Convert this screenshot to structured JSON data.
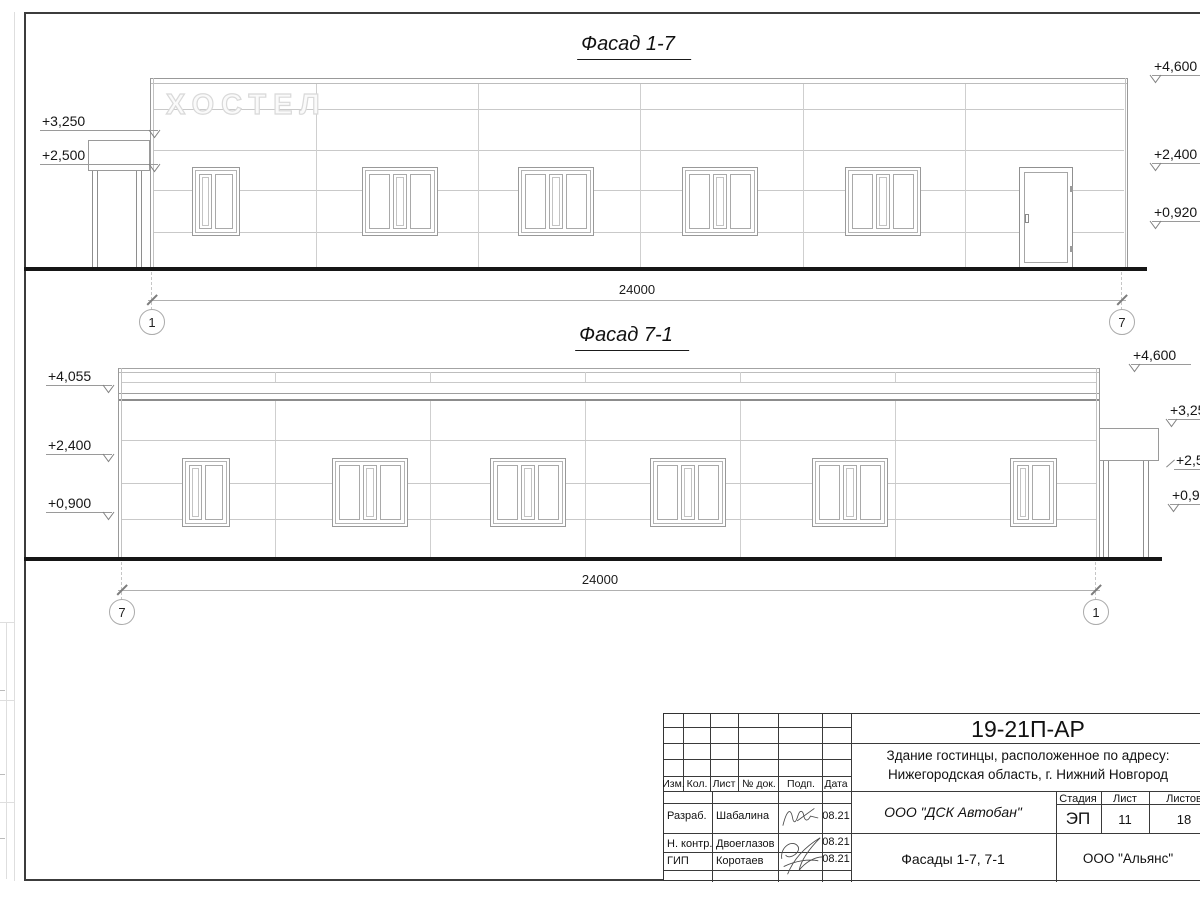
{
  "sheet": {
    "titles": {
      "facade1": "Фасад 1-7",
      "facade2": "Фасад 7-1"
    },
    "sign": "ХОСТЕЛ"
  },
  "facade1": {
    "marks_left": [
      "+3,250",
      "+2,500"
    ],
    "marks_right": [
      "+4,600",
      "+2,400",
      "+0,920"
    ],
    "dimension": "24000",
    "axis_left": "1",
    "axis_right": "7"
  },
  "facade2": {
    "marks_left": [
      "+4,055",
      "+2,400",
      "+0,900"
    ],
    "marks_right": [
      "+4,600",
      "+3,250",
      "+2,500",
      "+0,920"
    ],
    "dimension": "24000",
    "axis_left": "7",
    "axis_right": "1"
  },
  "titleblock": {
    "doc_number": "19-21П-АР",
    "project_line1": "Здание гостинцы, расположенное по адресу:",
    "project_line2": "Нижегородская область, г. Нижний Новгород",
    "header_cols": [
      "Изм.",
      "Кол.",
      "Лист",
      "№ док.",
      "Подп.",
      "Дата"
    ],
    "rows": [
      {
        "role": "Разраб.",
        "name": "Шабалина",
        "date": "08.21"
      },
      {
        "role": "Н. контр.",
        "name": "Двоеглазов",
        "date": "08.21"
      },
      {
        "role": "ГИП",
        "name": "Коротаев",
        "date": "08.21"
      }
    ],
    "company": "ООО \"ДСК Автобан\"",
    "stage_label": "Стадия",
    "sheet_label": "Лист",
    "sheets_label": "Листов",
    "stage": "ЭП",
    "sheet": "11",
    "sheets": "18",
    "drawing_title": "Фасады 1-7, 7-1",
    "company2": "ООО \"Альянс\""
  }
}
